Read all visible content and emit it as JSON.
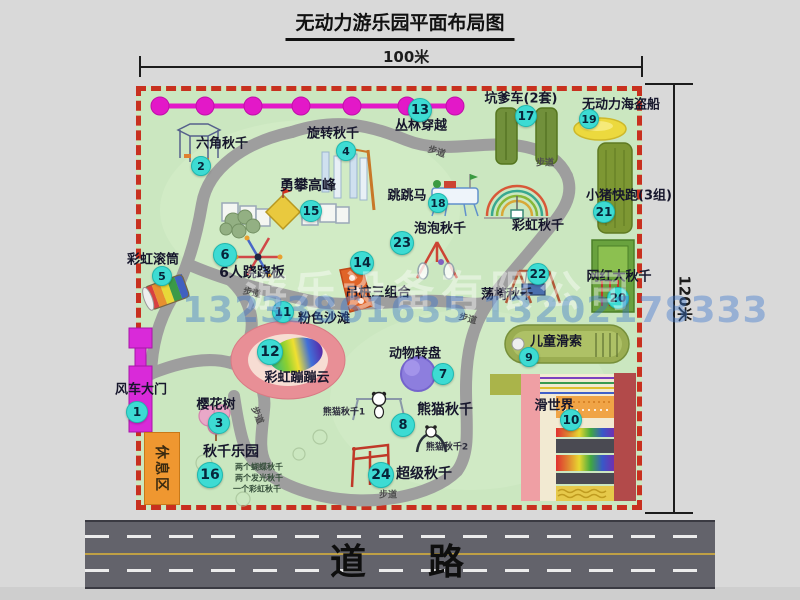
{
  "title": "无动力游乐园平面布局图",
  "dims": {
    "width_label": "100米",
    "height_label": "120米"
  },
  "road": {
    "label": "道路"
  },
  "watermark": {
    "company": "游乐设备有限公司",
    "phone": "13233861635 13202178333"
  },
  "rest_area": {
    "label": "休息区"
  },
  "colors": {
    "map_green": "#cbe7c0",
    "border_red": "#c8301f",
    "bubble_cyan": "#3ddbd3",
    "jungle_magenta": "#e318c8",
    "road_gray": "#63636b",
    "rest_orange": "#ef9730",
    "gate_magenta": "#d92ad9",
    "beach_pink": "#e88f96",
    "pirate_yellow": "#ecd93e"
  },
  "attractions": [
    {
      "no": 1,
      "name": "风车大门"
    },
    {
      "no": 2,
      "name": "六角秋千"
    },
    {
      "no": 3,
      "name": "樱花树"
    },
    {
      "no": 4,
      "name": "旋转秋千"
    },
    {
      "no": 5,
      "name": "彩虹滚筒"
    },
    {
      "no": 6,
      "name": "6人跷跷板"
    },
    {
      "no": 7,
      "name": "动物转盘"
    },
    {
      "no": 8,
      "name": "熊猫秋千"
    },
    {
      "no": 9,
      "name": "儿童滑索"
    },
    {
      "no": 10,
      "name": "滑世界"
    },
    {
      "no": 11,
      "name": "粉色沙滩"
    },
    {
      "no": 12,
      "name": "彩虹蹦蹦云"
    },
    {
      "no": 13,
      "name": "丛林穿越"
    },
    {
      "no": 14,
      "name": "吊桩三组合"
    },
    {
      "no": 15,
      "name": "勇攀高峰"
    },
    {
      "no": 16,
      "name": "秋千乐园",
      "note": "两个蝴蝶秋千 / 两个发光秋千 / 一个彩虹秋千"
    },
    {
      "no": 17,
      "name": "坑爹车(2套)"
    },
    {
      "no": 18,
      "name": "跳跳马"
    },
    {
      "no": 19,
      "name": "无动力海盗船"
    },
    {
      "no": 20,
      "name": "网红大秋千"
    },
    {
      "no": 21,
      "name": "小猪快跑(3组)"
    },
    {
      "no": 22,
      "name": "荡椅秋千"
    },
    {
      "no": 23,
      "name": "泡泡秋千"
    },
    {
      "no": 24,
      "name": "超级秋千"
    }
  ],
  "unnumbered_features": [
    "彩虹秋千",
    "休息区",
    "步道",
    "道路"
  ],
  "map": {
    "markers": [
      {
        "n": 1,
        "x": 136,
        "y": 411,
        "r": 10
      },
      {
        "n": 2,
        "x": 200,
        "y": 165,
        "r": 9
      },
      {
        "n": 3,
        "x": 218,
        "y": 422,
        "r": 10
      },
      {
        "n": 4,
        "x": 345,
        "y": 150,
        "r": 9
      },
      {
        "n": 5,
        "x": 161,
        "y": 275,
        "r": 9
      },
      {
        "n": 6,
        "x": 224,
        "y": 254,
        "r": 11
      },
      {
        "n": 7,
        "x": 442,
        "y": 373,
        "r": 10
      },
      {
        "n": 8,
        "x": 402,
        "y": 424,
        "r": 11
      },
      {
        "n": 9,
        "x": 528,
        "y": 356,
        "r": 9
      },
      {
        "n": 10,
        "x": 570,
        "y": 419,
        "r": 10
      },
      {
        "n": 11,
        "x": 282,
        "y": 311,
        "r": 10
      },
      {
        "n": 12,
        "x": 269,
        "y": 351,
        "r": 12
      },
      {
        "n": 13,
        "x": 419,
        "y": 109,
        "r": 11
      },
      {
        "n": 14,
        "x": 361,
        "y": 262,
        "r": 11
      },
      {
        "n": 15,
        "x": 310,
        "y": 210,
        "r": 10
      },
      {
        "n": 16,
        "x": 209,
        "y": 474,
        "r": 12
      },
      {
        "n": 17,
        "x": 525,
        "y": 115,
        "r": 10
      },
      {
        "n": 18,
        "x": 437,
        "y": 202,
        "r": 9
      },
      {
        "n": 19,
        "x": 588,
        "y": 118,
        "r": 9
      },
      {
        "n": 20,
        "x": 617,
        "y": 297,
        "r": 10
      },
      {
        "n": 21,
        "x": 603,
        "y": 211,
        "r": 10
      },
      {
        "n": 22,
        "x": 537,
        "y": 273,
        "r": 10
      },
      {
        "n": 23,
        "x": 401,
        "y": 242,
        "r": 11
      },
      {
        "n": 24,
        "x": 380,
        "y": 474,
        "r": 12
      }
    ],
    "labels": [
      {
        "name": "label-liujiao-qiuqian",
        "text": "六角秋千",
        "x": 222,
        "y": 142
      },
      {
        "name": "label-xuanzhuan-qiuqian",
        "text": "旋转秋千",
        "x": 333,
        "y": 132
      },
      {
        "name": "label-conglin-chuanyue",
        "text": "丛林穿越",
        "x": 421,
        "y": 124
      },
      {
        "name": "label-yongpan-gaofeng",
        "text": "勇攀高峰",
        "x": 308,
        "y": 185,
        "size": 14
      },
      {
        "name": "label-kengdieche",
        "text": "坑爹车(2套)",
        "x": 521,
        "y": 97
      },
      {
        "name": "label-haidaochuan",
        "text": "无动力海盗船",
        "x": 621,
        "y": 103
      },
      {
        "name": "label-xiaozhu-kuaipao",
        "text": "小猪快跑(3组)",
        "x": 629,
        "y": 194
      },
      {
        "name": "label-caihong-guntong",
        "text": "彩虹滚筒",
        "x": 153,
        "y": 258
      },
      {
        "name": "label-qiaoqiaoban",
        "text": "6人跷跷板",
        "x": 252,
        "y": 272,
        "size": 14
      },
      {
        "name": "label-paopao-qiuqian",
        "text": "泡泡秋千",
        "x": 440,
        "y": 227
      },
      {
        "name": "label-caihong-qiuqian",
        "text": "彩虹秋千",
        "x": 538,
        "y": 224
      },
      {
        "name": "label-tiaotiaoma",
        "text": "跳跳马",
        "x": 407,
        "y": 194
      },
      {
        "name": "label-diaozhuang-sanzuhe",
        "text": "吊桩三组合",
        "x": 378,
        "y": 291
      },
      {
        "name": "label-fense-shatan",
        "text": "粉色沙滩",
        "x": 324,
        "y": 317
      },
      {
        "name": "label-dangyi-qiuqian",
        "text": "荡椅秋千",
        "x": 507,
        "y": 293
      },
      {
        "name": "label-wanghong-daqiuqian",
        "text": "网红大秋千",
        "x": 619,
        "y": 275
      },
      {
        "name": "label-ertong-huasuo",
        "text": "儿童滑索",
        "x": 556,
        "y": 340
      },
      {
        "name": "label-huashijie",
        "text": "滑世界",
        "x": 554,
        "y": 404
      },
      {
        "name": "label-dongwu-zhuanpan",
        "text": "动物转盘",
        "x": 415,
        "y": 352
      },
      {
        "name": "label-caihong-bengbengyun",
        "text": "彩虹蹦蹦云",
        "x": 297,
        "y": 376
      },
      {
        "name": "label-xiongmao-qiuqian",
        "text": "熊猫秋千",
        "x": 445,
        "y": 409,
        "size": 14
      },
      {
        "name": "label-xiongmao-qiuqian-1",
        "text": "熊猫秋千1",
        "x": 344,
        "y": 411,
        "size": 9,
        "color": "#2e2e3e"
      },
      {
        "name": "label-xiongmao-qiuqian-2",
        "text": "熊猫秋千2",
        "x": 447,
        "y": 446,
        "size": 9,
        "color": "#2e2e3e"
      },
      {
        "name": "label-chaoji-qiuqian",
        "text": "超级秋千",
        "x": 424,
        "y": 473,
        "size": 14
      },
      {
        "name": "label-fengche-damen",
        "text": "风车大门",
        "x": 141,
        "y": 388
      },
      {
        "name": "label-yinghuashu",
        "text": "樱花树",
        "x": 216,
        "y": 403
      },
      {
        "name": "label-qiuqian-leyuan",
        "text": "秋千乐园",
        "x": 231,
        "y": 451,
        "size": 14
      },
      {
        "name": "label-swing-note-1",
        "text": "两个蝴蝶秋千",
        "x": 259,
        "y": 467,
        "size": 8,
        "color": "#37503c"
      },
      {
        "name": "label-swing-note-2",
        "text": "两个发光秋千",
        "x": 259,
        "y": 478,
        "size": 8,
        "color": "#37503c"
      },
      {
        "name": "label-swing-note-3",
        "text": "一个彩虹秋千",
        "x": 257,
        "y": 489,
        "size": 8,
        "color": "#37503c"
      },
      {
        "name": "label-budao-1",
        "text": "步道",
        "x": 437,
        "y": 151,
        "size": 9,
        "rot": 18,
        "color": "#4f4f4f"
      },
      {
        "name": "label-budao-2",
        "text": "步道",
        "x": 545,
        "y": 162,
        "size": 9,
        "color": "#4f4f4f"
      },
      {
        "name": "label-budao-3",
        "text": "步道",
        "x": 252,
        "y": 292,
        "size": 9,
        "rot": 12,
        "color": "#4f4f4f"
      },
      {
        "name": "label-budao-4",
        "text": "步道",
        "x": 468,
        "y": 318,
        "size": 9,
        "rot": 15,
        "color": "#4f4f4f"
      },
      {
        "name": "label-budao-5",
        "text": "步道",
        "x": 388,
        "y": 494,
        "size": 9,
        "color": "#4f4f4f"
      },
      {
        "name": "label-budao-6",
        "text": "步道",
        "x": 258,
        "y": 415,
        "size": 9,
        "rot": 68,
        "color": "#4f4f4f"
      }
    ]
  }
}
